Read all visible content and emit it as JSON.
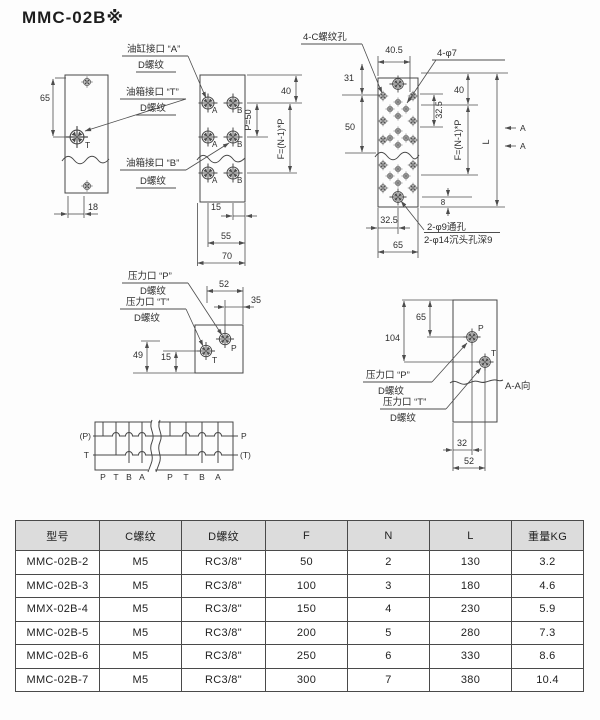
{
  "title": "MMC-02B※",
  "labels": {
    "cyl_a": "油缸接口 “A”",
    "tank_t": "油箱接口 “T”",
    "tank_b": "油箱接口 “B”",
    "press_p": "压力口 “P”",
    "press_t": "压力口 “T”",
    "d_thread": "D螺纹",
    "c_holes": "4-C螺纹孔",
    "phi7": "4-φ7",
    "phi9": "2-φ9通孔",
    "phi14": "2-φ14沉头孔深9",
    "section": "A-A向",
    "port_a": "A",
    "port_b": "B",
    "port_p": "P",
    "port_t": "T"
  },
  "dims": {
    "d8": "8",
    "d15": "15",
    "d18": "18",
    "d31": "31",
    "d32": "32",
    "d32_5": "32.5",
    "d35": "35",
    "d40": "40",
    "d40_5": "40.5",
    "d49": "49",
    "d50": "50",
    "d52": "52",
    "d55": "55",
    "d65": "65",
    "d70": "70",
    "d104": "104",
    "p50": "P=50",
    "f_formula": "F=(N-1)*P",
    "l": "L",
    "a": "A"
  },
  "schematic": {
    "left_top": "(P)",
    "left_bottom": "T",
    "right_top": "P",
    "right_bottom": "(T)",
    "ports": [
      "P",
      "T",
      "B",
      "A"
    ]
  },
  "table": {
    "headers": [
      "型号",
      "C螺纹",
      "D螺纹",
      "F",
      "N",
      "L",
      "重量KG"
    ],
    "rows": [
      [
        "MMC-02B-2",
        "M5",
        "RC3/8\"",
        "50",
        "2",
        "130",
        "3.2"
      ],
      [
        "MMC-02B-3",
        "M5",
        "RC3/8\"",
        "100",
        "3",
        "180",
        "4.6"
      ],
      [
        "MMX-02B-4",
        "M5",
        "RC3/8\"",
        "150",
        "4",
        "230",
        "5.9"
      ],
      [
        "MMC-02B-5",
        "M5",
        "RC3/8\"",
        "200",
        "5",
        "280",
        "7.3"
      ],
      [
        "MMC-02B-6",
        "M5",
        "RC3/8\"",
        "250",
        "6",
        "330",
        "8.6"
      ],
      [
        "MMC-02B-7",
        "M5",
        "RC3/8\"",
        "300",
        "7",
        "380",
        "10.4"
      ]
    ]
  }
}
